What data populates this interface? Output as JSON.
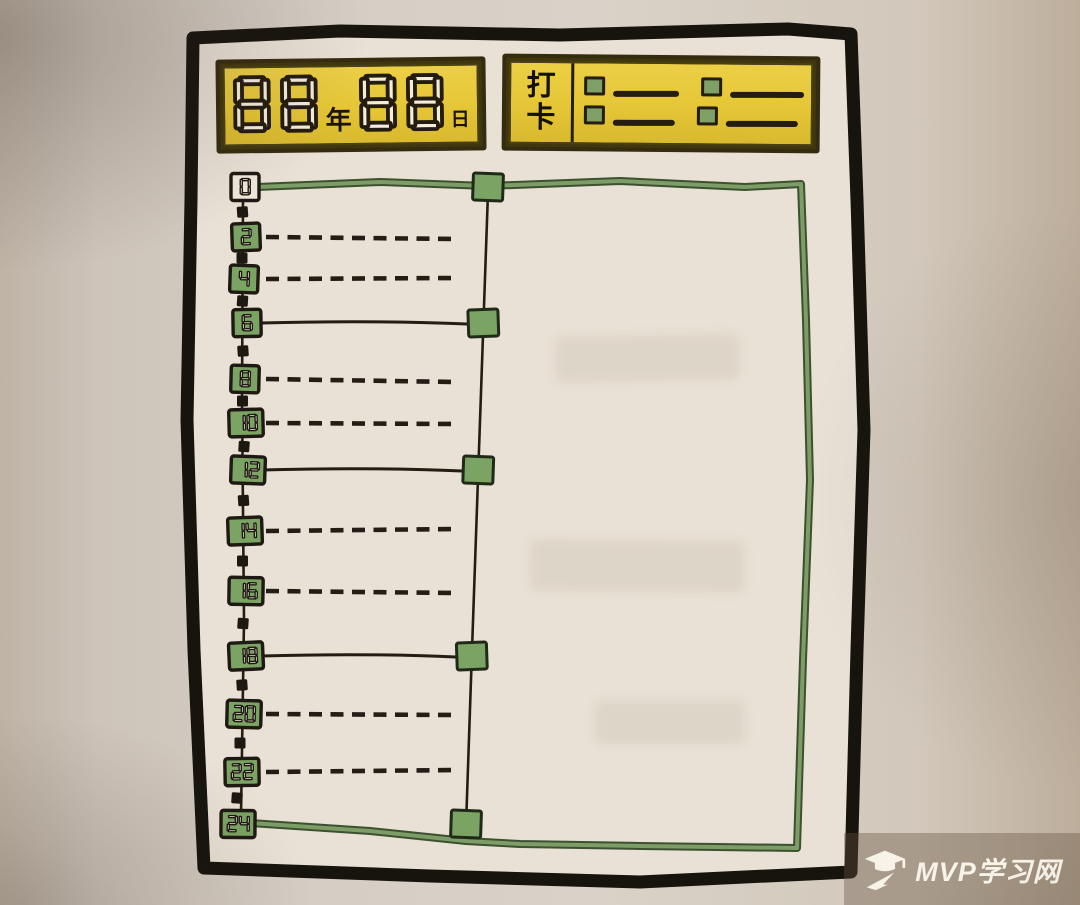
{
  "date_box": {
    "digits_left": "88",
    "label_year": "年",
    "digits_right": "88",
    "label_day": "日"
  },
  "checkin_box": {
    "label": [
      "打",
      "卡"
    ],
    "rows": [
      {
        "slots": 2
      },
      {
        "slots": 2
      }
    ]
  },
  "timeline": {
    "hours": [
      0,
      2,
      4,
      6,
      8,
      10,
      12,
      14,
      16,
      18,
      20,
      22,
      24
    ],
    "marker_hours": [
      0,
      6,
      12,
      18,
      24
    ]
  },
  "watermark": {
    "text": "MVP学习网"
  },
  "colors": {
    "paper": "#e9e1d5",
    "ink": "#241d15",
    "frame_ink": "#17130d",
    "yellow": "#e5c636",
    "green_dark": "#3c5130",
    "green_mid": "#7d9c66",
    "green_fill": "#7ba364",
    "segment_fill": "#f4eddc",
    "watermark_text": "#f7f3e9"
  }
}
